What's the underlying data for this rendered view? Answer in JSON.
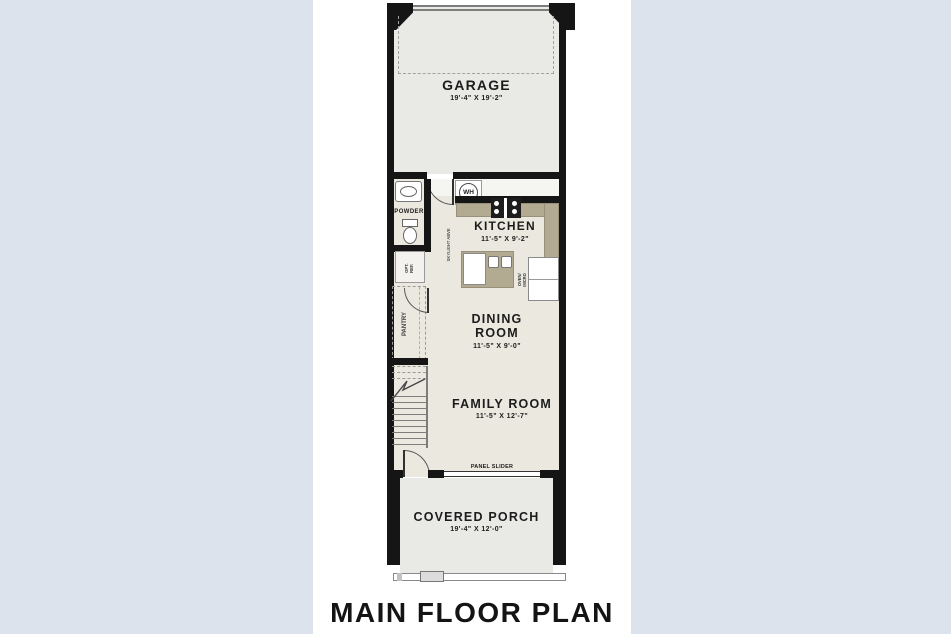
{
  "page": {
    "title": "MAIN FLOOR PLAN"
  },
  "colors": {
    "background": "#dde3ec",
    "paper": "#ffffff",
    "wall": "#151515",
    "floor-garage": "#e9e9e6",
    "floor-interior": "#eae8df",
    "counter": "#b3ab91",
    "text": "#1c1c1c"
  },
  "rooms": {
    "garage": {
      "label": "GARAGE",
      "dims": "19'-4\" X 19'-2\""
    },
    "kitchen": {
      "label": "KITCHEN",
      "dims": "11'-5\" X 9'-2\""
    },
    "dining_room": {
      "label_line1": "DINING",
      "label_line2": "ROOM",
      "dims": "11'-5\" X 9'-0\""
    },
    "family_room": {
      "label": "FAMILY ROOM",
      "dims": "11'-5\" X 12'-7\""
    },
    "covered_porch": {
      "label": "COVERED PORCH",
      "dims": "19'-4\" X 12'-0\""
    },
    "powder": {
      "label": "POWDER"
    },
    "pantry": {
      "label": "PANTRY"
    }
  },
  "fixtures": {
    "water_heater": "WH",
    "panel_slider": "PANEL SLIDER",
    "skylight": "SKYLIGHT ABVE",
    "oven_micro_line1": "OVEN/",
    "oven_micro_line2": "MICRO",
    "opt_closet_line1": "OPT.",
    "opt_closet_line2": "REF."
  }
}
